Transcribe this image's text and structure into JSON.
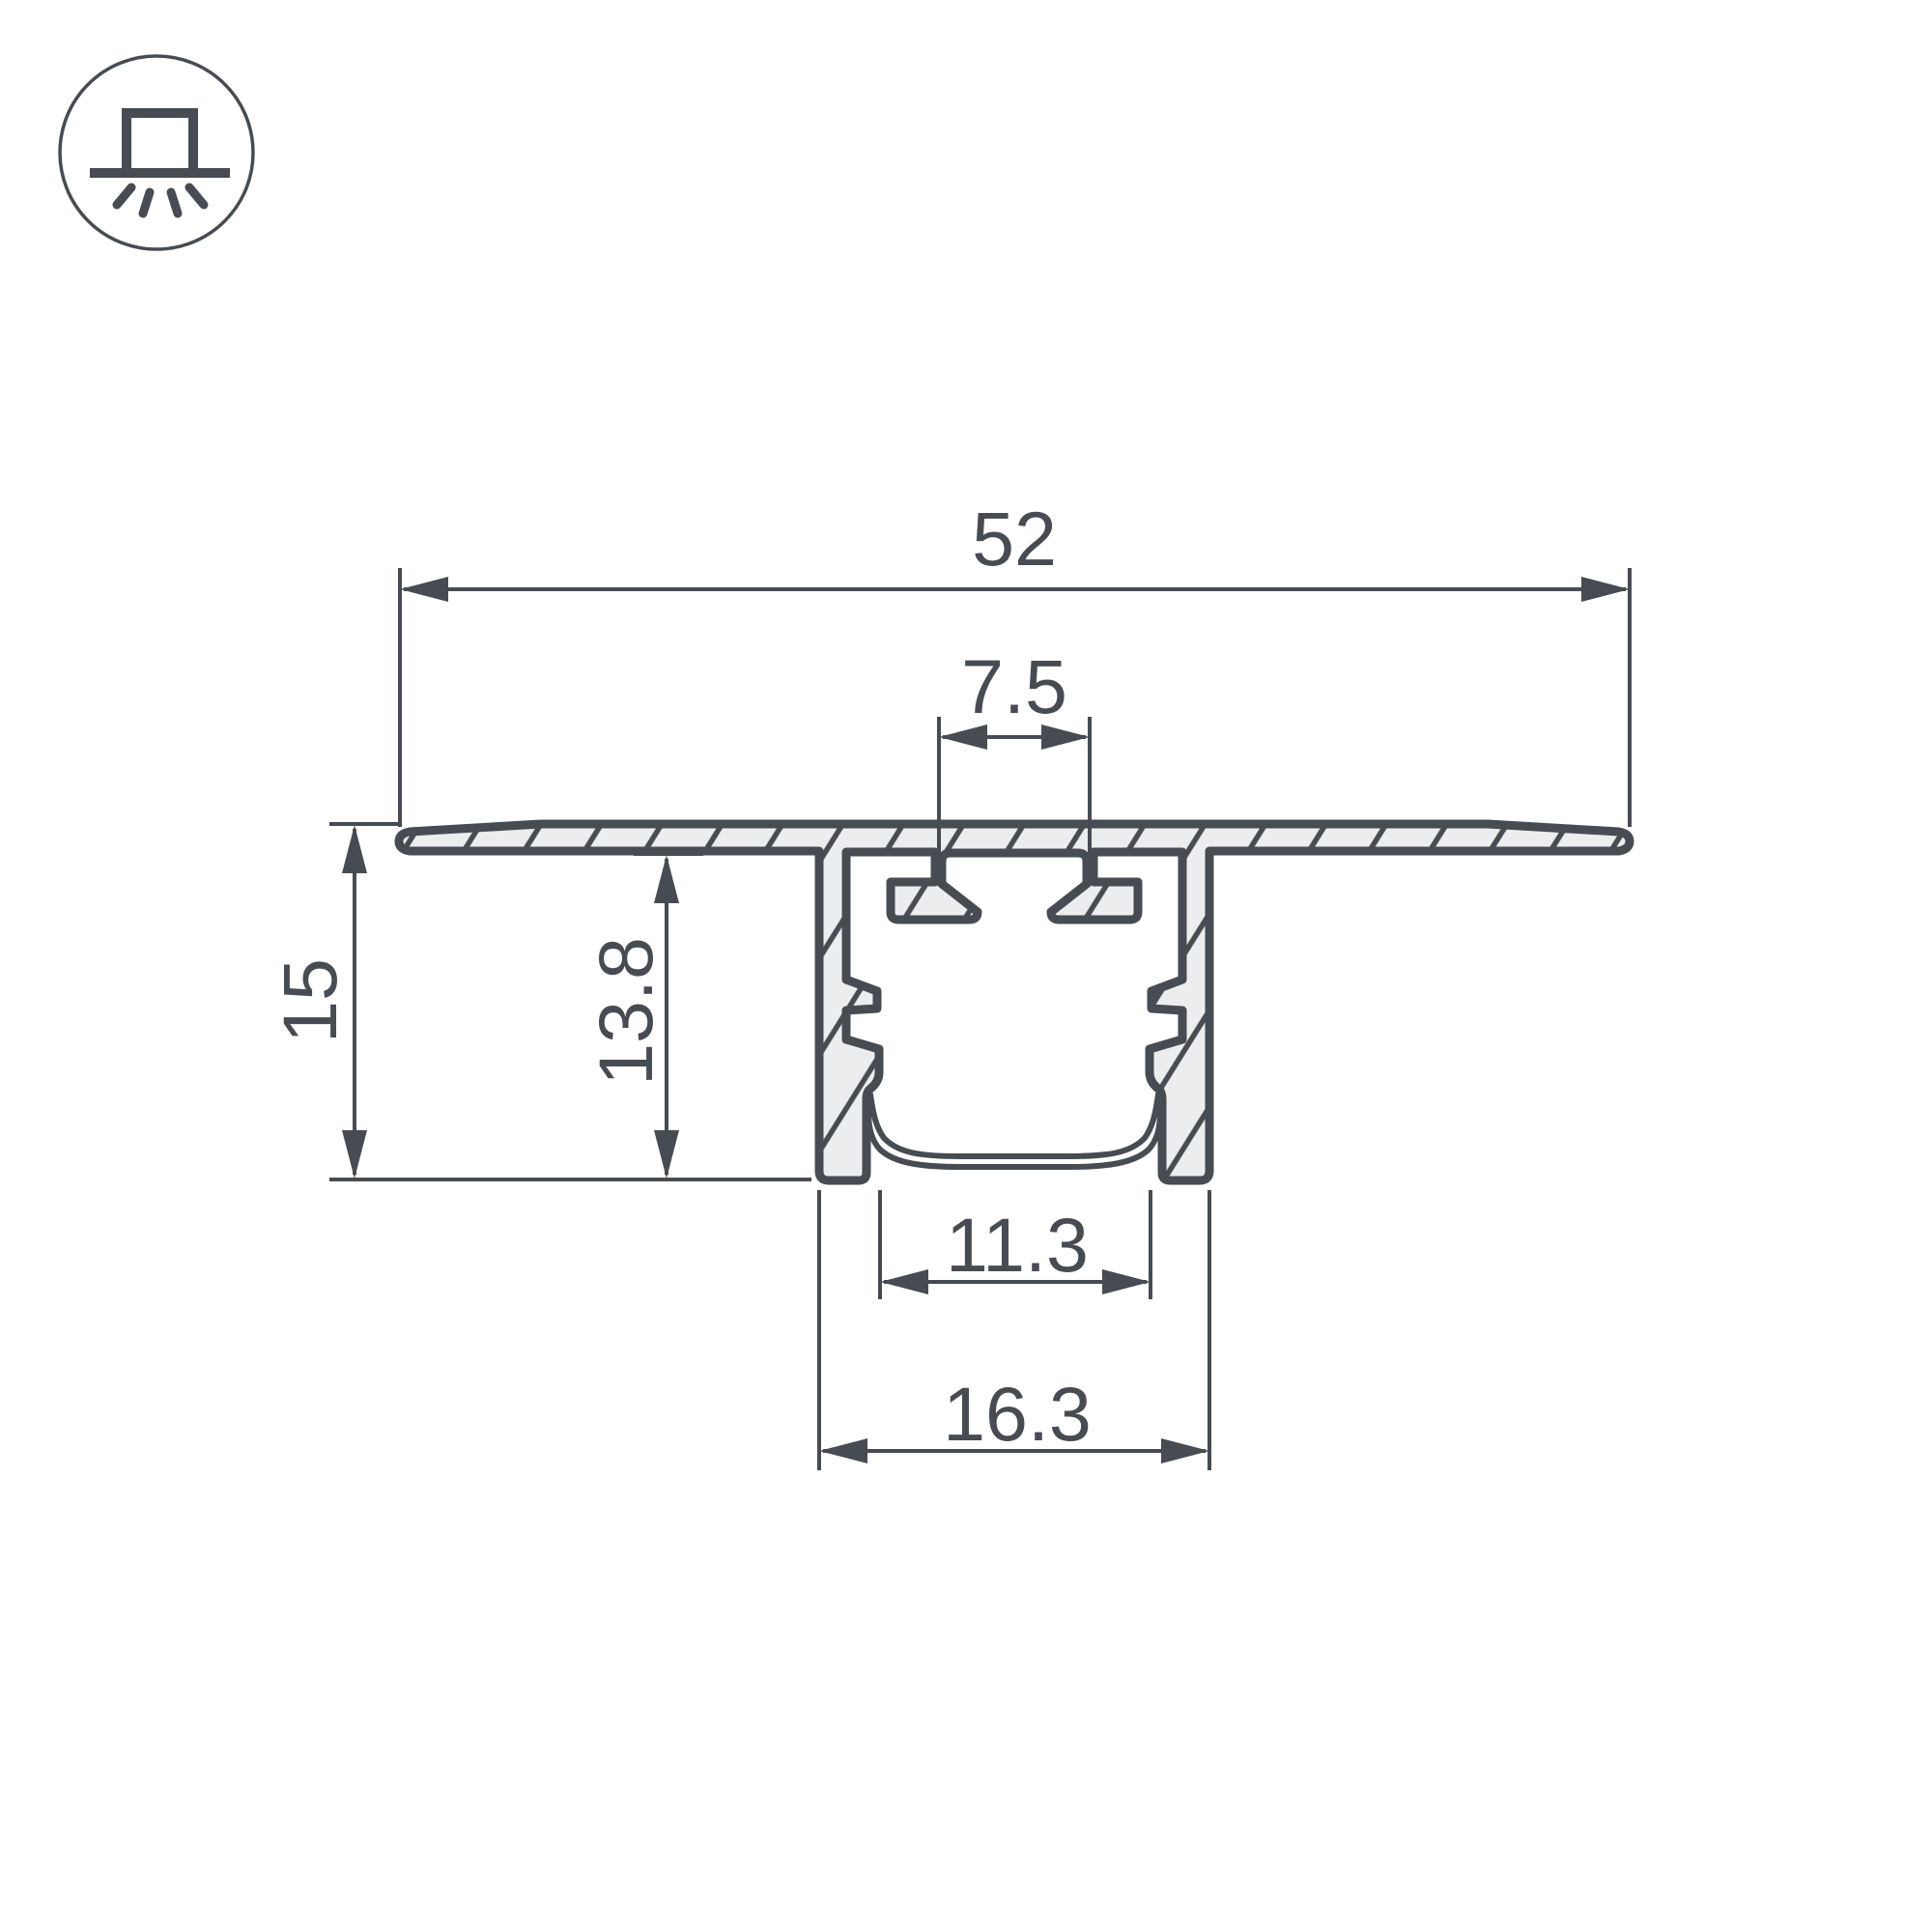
{
  "drawing": {
    "type": "profile-cross-section",
    "icon": {
      "name": "recessed-light-icon"
    },
    "dimensions": {
      "overall_width": "52",
      "clip_slot_width": "7.5",
      "total_height": "15",
      "body_height": "13.8",
      "inner_width": "11.3",
      "body_width": "16.3"
    },
    "colors": {
      "line": "#474c52",
      "fill": "#ecedee",
      "background": "#ffffff"
    }
  }
}
